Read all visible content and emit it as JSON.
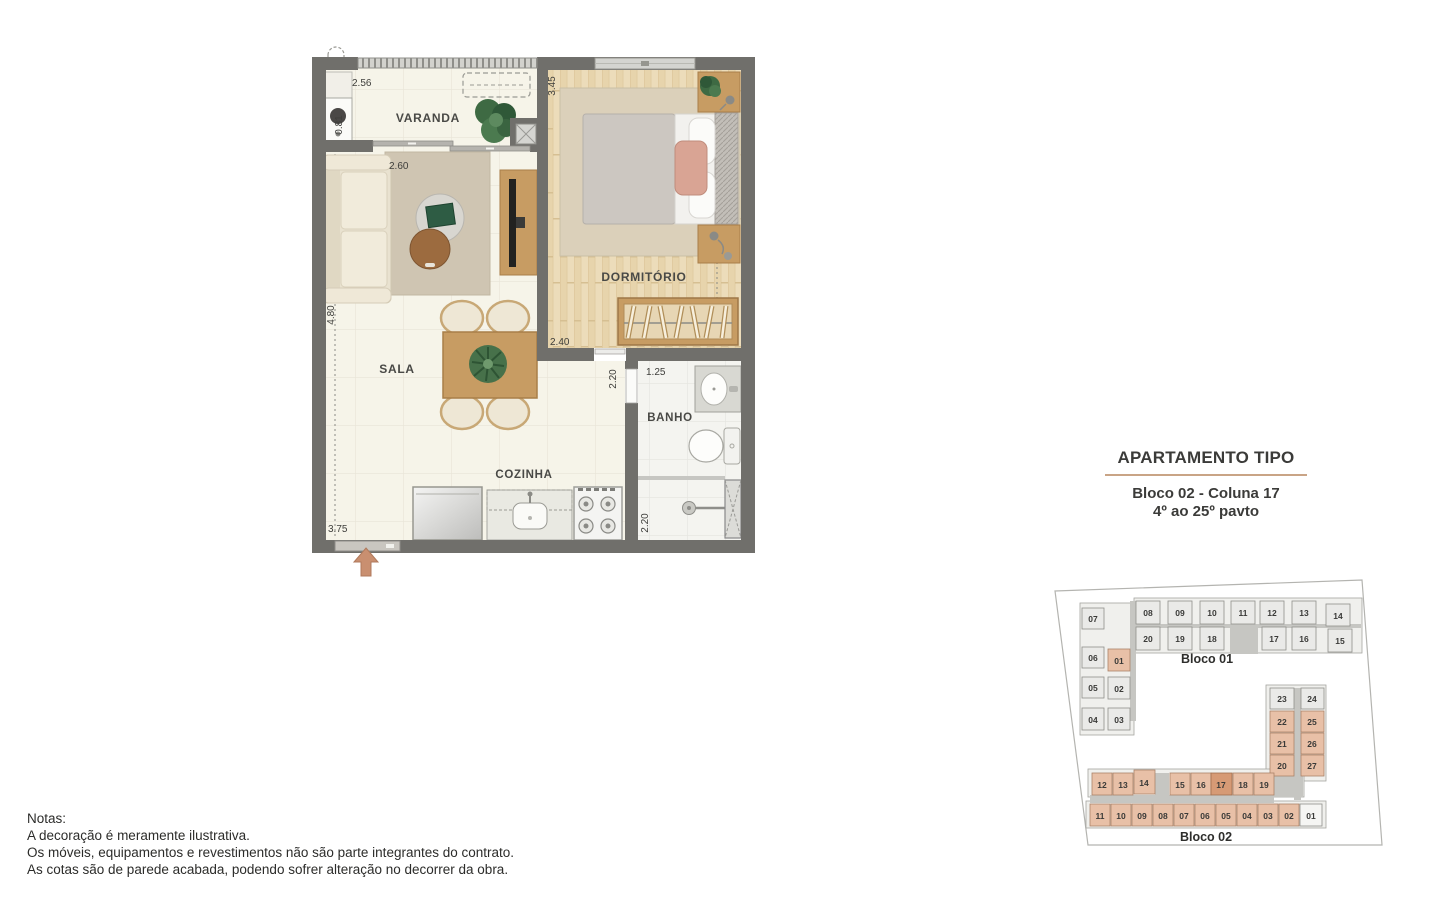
{
  "plan": {
    "rooms": {
      "varanda": "VARANDA",
      "sala": "SALA",
      "cozinha": "COZINHA",
      "dormitorio": "DORMITÓRIO",
      "banho": "BANHO"
    },
    "dimensions": {
      "varanda_width": "2.56",
      "varanda_depth": "0.81",
      "sala_width": "2.60",
      "sala_depth": "4.80",
      "sala_bottom": "3.75",
      "dormitorio_depth": "3.45",
      "dormitorio_width": "2.40",
      "banho_width": "1.25",
      "banho_shower_depth": "2.20",
      "passage_depth": "2.20"
    }
  },
  "title_block": {
    "title": "APARTAMENTO TIPO",
    "subtitle_line1": "Bloco 02 - Coluna 17",
    "subtitle_line2": "4º ao 25º pavto"
  },
  "site_map": {
    "highlighted_unit": "17",
    "bloco01": {
      "label": "Bloco 01",
      "units": {
        "u07": "07",
        "u06": "06",
        "u05": "05",
        "u04": "04",
        "u01": "01",
        "u02": "02",
        "u03": "03",
        "u08": "08",
        "u09": "09",
        "u10": "10",
        "u11": "11",
        "u12": "12",
        "u13": "13",
        "u14": "14",
        "u20": "20",
        "u19": "19",
        "u18": "18",
        "u17": "17",
        "u16": "16",
        "u15": "15"
      }
    },
    "bloco02": {
      "label": "Bloco 02",
      "units": {
        "u23": "23",
        "u24": "24",
        "u22": "22",
        "u25": "25",
        "u21": "21",
        "u26": "26",
        "u20": "20",
        "u27": "27",
        "u12": "12",
        "u13": "13",
        "u14": "14",
        "u15": "15",
        "u16": "16",
        "u17": "17",
        "u18": "18",
        "u19": "19",
        "u11": "11",
        "u10": "10",
        "u09": "09",
        "u08": "08",
        "u07": "07",
        "u06": "06",
        "u05": "05",
        "u04": "04",
        "u03": "03",
        "u02": "02",
        "u01": "01"
      }
    }
  },
  "notes": {
    "heading": "Notas:",
    "line1": "A decoração é meramente ilustrativa.",
    "line2": "Os móveis, equipamentos e revestimentos não são parte integrantes do contrato.",
    "line3": "As cotas são de parede acabada, podendo sofrer alteração no decorrer da obra."
  }
}
